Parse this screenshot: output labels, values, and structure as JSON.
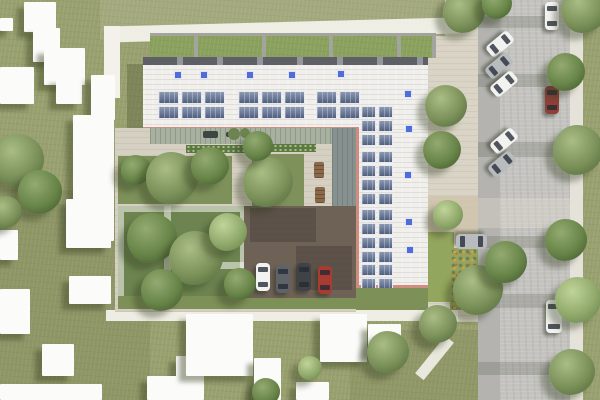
{
  "meta": {
    "description": "Aerial architectural site-plan rendering: L-shaped building with white roof, rooftop solar panel arrays and blue skylights, green roof strips, inner courtyard garden with pergola and tree plots, small parking court with four cars, surrounding lawn with abstract white neighbor buildings, and a street on the right with angle-parked and moving cars, sidewalk and trees"
  },
  "palette": {
    "lawn": "#99a06f",
    "plaza": "#dad4c6",
    "gravel": "#cfc3ab",
    "street": "#c4c3c0",
    "street_lane": "#b4b3b0",
    "sidewalk": "#e5e2da",
    "path_white": "#f3f1ea",
    "roof": "#f0efec",
    "roof_edge": "#62646a",
    "parapet": "#cf8d80",
    "green_roof": "#8aa15e",
    "divider": "#a3a49e",
    "skylight": "#4f6cd8",
    "solar": "#5a6b8c",
    "deck": "#a8b0a0",
    "canopy": "#87918f",
    "garden": "#7e915b",
    "garden_dense": "#6d8450",
    "hedge": "#5d7847",
    "green_strip": "#7d9057",
    "parking": "#6e6156",
    "flower_base": "#95a45e",
    "bench": "#8a6a4a",
    "car_white": "#f2f2f0",
    "car_silver": "#b9bcbe",
    "car_gray": "#5f6368",
    "car_black": "#3f4347",
    "car_red": "#a83c32",
    "car_maroon": "#8d4038"
  },
  "layers": {
    "ground": [
      {
        "x": 0,
        "y": 0,
        "w": 600,
        "h": 400,
        "fill": "lawn",
        "cls": "tex-lawn"
      },
      {
        "x": 0,
        "y": 190,
        "w": 150,
        "h": 210,
        "fill": "rgba(84,94,52,0.15)"
      },
      {
        "x": 350,
        "y": 330,
        "w": 130,
        "h": 70,
        "fill": "rgba(84,94,52,0.12)"
      },
      {
        "x": 100,
        "y": 0,
        "w": 380,
        "h": 40,
        "fill": "rgba(255,255,252,0.10)"
      }
    ],
    "east_plaza": [
      {
        "x": 428,
        "y": 36,
        "w": 50,
        "h": 286,
        "fill": "plaza",
        "cls": "tex-pave"
      },
      {
        "x": 445,
        "y": 0,
        "w": 33,
        "h": 36,
        "fill": "plaza",
        "cls": "tex-pave"
      },
      {
        "x": 428,
        "y": 196,
        "w": 50,
        "h": 40,
        "fill": "gravel",
        "op": 0.85
      },
      {
        "x": 428,
        "y": 232,
        "w": 26,
        "h": 70,
        "fill": "#93a65d"
      },
      {
        "x": 450,
        "y": 248,
        "w": 28,
        "h": 62,
        "fill": "flower_base",
        "cls": "flowers"
      }
    ],
    "street": {
      "road": {
        "x": 478,
        "y": 0,
        "w": 92,
        "h": 400,
        "fill": "street",
        "cls": "tex-road"
      },
      "parking_lane": {
        "x": 478,
        "y": 0,
        "w": 22,
        "h": 400,
        "fill": "street_lane"
      },
      "sidewalk": {
        "x": 570,
        "y": 0,
        "w": 13,
        "h": 400,
        "fill": "sidewalk"
      },
      "crossing": {
        "x": 478,
        "y": 198,
        "w": 92,
        "h": 30,
        "fill": "rgba(236,231,216,0.28)"
      },
      "tree_shadows": [
        {
          "x": 478,
          "y": 16,
          "w": 66,
          "h": 12,
          "fill": "rgba(82,88,74,0.22)"
        },
        {
          "x": 478,
          "y": 74,
          "w": 82,
          "h": 13,
          "fill": "rgba(82,88,74,0.22)"
        },
        {
          "x": 478,
          "y": 142,
          "w": 88,
          "h": 15,
          "fill": "rgba(82,88,74,0.22)"
        },
        {
          "x": 478,
          "y": 236,
          "w": 74,
          "h": 12,
          "fill": "rgba(82,88,74,0.22)"
        },
        {
          "x": 478,
          "y": 294,
          "w": 86,
          "h": 14,
          "fill": "rgba(82,88,74,0.22)"
        },
        {
          "x": 478,
          "y": 362,
          "w": 72,
          "h": 13,
          "fill": "rgba(82,88,74,0.22)"
        }
      ]
    },
    "paths": [
      {
        "x": 104,
        "y": 22,
        "w": 356,
        "h": 16,
        "rot": -1.5,
        "fill": "path_white",
        "op": 0.95
      },
      {
        "x": 104,
        "y": 26,
        "w": 16,
        "h": 72,
        "fill": "path_white"
      },
      {
        "x": 106,
        "y": 310,
        "w": 352,
        "h": 11,
        "fill": "path_white",
        "op": 0.95
      },
      {
        "x": 429,
        "y": 334,
        "w": 11,
        "h": 48,
        "rot": 39,
        "fill": "path_white",
        "op": 0.9
      }
    ],
    "neighbor_buildings": [
      {
        "x": 24,
        "y": 2,
        "w": 32,
        "h": 30
      },
      {
        "x": 33,
        "y": 28,
        "w": 27,
        "h": 34
      },
      {
        "x": 44,
        "y": 48,
        "w": 41,
        "h": 37
      },
      {
        "x": 0,
        "y": 67,
        "w": 34,
        "h": 37
      },
      {
        "x": 56,
        "y": 78,
        "w": 26,
        "h": 26
      },
      {
        "x": 0,
        "y": 18,
        "w": 13,
        "h": 13
      },
      {
        "x": 91,
        "y": 75,
        "w": 24,
        "h": 45
      },
      {
        "x": 73,
        "y": 115,
        "w": 41,
        "h": 126
      },
      {
        "x": 66,
        "y": 199,
        "w": 45,
        "h": 49
      },
      {
        "x": 69,
        "y": 276,
        "w": 42,
        "h": 28
      },
      {
        "x": 0,
        "y": 289,
        "w": 30,
        "h": 45
      },
      {
        "x": 42,
        "y": 344,
        "w": 32,
        "h": 32
      },
      {
        "x": 0,
        "y": 230,
        "w": 18,
        "h": 30
      },
      {
        "x": 176,
        "y": 356,
        "w": 28,
        "h": 44
      },
      {
        "x": 147,
        "y": 376,
        "w": 30,
        "h": 24
      },
      {
        "x": 186,
        "y": 314,
        "w": 67,
        "h": 62
      },
      {
        "x": 254,
        "y": 358,
        "w": 27,
        "h": 42
      },
      {
        "x": 320,
        "y": 314,
        "w": 47,
        "h": 48
      },
      {
        "x": 368,
        "y": 324,
        "w": 33,
        "h": 30
      },
      {
        "x": 296,
        "y": 382,
        "w": 33,
        "h": 18
      },
      {
        "x": 0,
        "y": 384,
        "w": 102,
        "h": 16
      }
    ],
    "building": {
      "green_strip_border": {
        "x": 150,
        "y": 33,
        "w": 286,
        "h": 4,
        "fill": "divider"
      },
      "green_strips": {
        "x": 150,
        "y": 36,
        "w": 286,
        "h": 22,
        "fill": "green_roof",
        "cls": "tex-lawn"
      },
      "strip_dividers": [
        194,
        262,
        329,
        397,
        432
      ],
      "roof_edge": {
        "x": 143,
        "y": 57,
        "w": 285,
        "h": 8
      },
      "shadow_west": {
        "x": 127,
        "y": 64,
        "w": 16,
        "h": 66,
        "fill": "rgba(62,72,40,0.30)"
      },
      "top_wing": {
        "x": 143,
        "y": 65,
        "w": 285,
        "h": 65,
        "fill": "roof",
        "cls": "tex-roof"
      },
      "right_wing": {
        "x": 356,
        "y": 130,
        "w": 72,
        "h": 158,
        "fill": "roof",
        "cls": "tex-roof"
      },
      "parapets": [
        {
          "x": 143,
          "y": 127,
          "w": 213,
          "h": 3
        },
        {
          "x": 356,
          "y": 127,
          "w": 3,
          "h": 161
        },
        {
          "x": 356,
          "y": 285,
          "w": 72,
          "h": 3
        }
      ],
      "skylights": [
        [
          174,
          71
        ],
        [
          200,
          71
        ],
        [
          246,
          71
        ],
        [
          288,
          71
        ],
        [
          337,
          70
        ],
        [
          404,
          90
        ],
        [
          405,
          125
        ],
        [
          404,
          171
        ],
        [
          405,
          218
        ],
        [
          406,
          246
        ]
      ],
      "solar_top": [
        {
          "x": 158,
          "y": 91,
          "cols": 3,
          "rows": 2
        },
        {
          "x": 238,
          "y": 91,
          "cols": 3,
          "rows": 2
        },
        {
          "x": 316,
          "y": 91,
          "cols": 2,
          "rows": 2
        }
      ],
      "solar_right": [
        {
          "x": 361,
          "y": 106,
          "cols": 2,
          "rows": 3
        },
        {
          "x": 361,
          "y": 151,
          "cols": 2,
          "rows": 4
        },
        {
          "x": 361,
          "y": 209,
          "cols": 2,
          "rows": 4
        },
        {
          "x": 361,
          "y": 264,
          "cols": 2,
          "rows": 2
        }
      ]
    },
    "courtyard": {
      "ground": {
        "x": 115,
        "y": 128,
        "w": 241,
        "h": 184,
        "fill": "#d6d0c2",
        "cls": "tex-pave"
      },
      "deck": {
        "x": 150,
        "y": 128,
        "w": 206,
        "h": 16,
        "fill": "deck"
      },
      "deck_items": [
        {
          "x": 203,
          "y": 131,
          "w": 15,
          "h": 7
        },
        {
          "x": 226,
          "y": 132,
          "w": 9,
          "h": 5
        }
      ],
      "deck_plants": [
        [
          234,
          134,
          6
        ],
        [
          245,
          133,
          5
        ]
      ],
      "canopy": {
        "x": 332,
        "y": 128,
        "w": 24,
        "h": 126,
        "fill": "canopy"
      },
      "hedges": [
        {
          "x": 186,
          "y": 145,
          "w": 66,
          "h": 8,
          "fill": "hedge"
        },
        {
          "x": 258,
          "y": 144,
          "w": 58,
          "h": 8,
          "fill": "hedge"
        }
      ],
      "plots": [
        {
          "x": 118,
          "y": 156,
          "w": 114,
          "h": 48,
          "fill": "garden"
        },
        {
          "x": 252,
          "y": 154,
          "w": 52,
          "h": 80,
          "fill": "garden"
        },
        {
          "x": 118,
          "y": 206,
          "w": 128,
          "h": 102,
          "fill": "garden_dense"
        }
      ],
      "pergola": {
        "x": 118,
        "y": 206,
        "w": 128,
        "h": 102
      },
      "pergola_bars": [
        {
          "x": 164,
          "y": 206,
          "w": 7,
          "h": 102
        },
        {
          "x": 171,
          "y": 262,
          "w": 75,
          "h": 7
        }
      ],
      "benches": [
        [
          314,
          162
        ],
        [
          315,
          187
        ],
        [
          315,
          212
        ]
      ],
      "green_strips": [
        {
          "x": 118,
          "y": 296,
          "w": 238,
          "h": 13,
          "fill": "green_strip"
        },
        {
          "x": 356,
          "y": 288,
          "w": 72,
          "h": 22,
          "fill": "green_strip"
        }
      ],
      "parking": {
        "x": 244,
        "y": 206,
        "w": 112,
        "h": 92,
        "fill": "parking",
        "cls": "tex-pave"
      },
      "parking_shadows": [
        {
          "x": 250,
          "y": 208,
          "w": 66,
          "h": 34,
          "fill": "rgba(40,36,30,0.25)"
        },
        {
          "x": 296,
          "y": 246,
          "w": 56,
          "h": 44,
          "fill": "rgba(40,36,30,0.25)"
        }
      ]
    },
    "vehicles": {
      "courtyard_parked": [
        {
          "x": 256,
          "y": 263,
          "color": "car_white"
        },
        {
          "x": 276,
          "y": 265,
          "color": "car_gray"
        },
        {
          "x": 297,
          "y": 263,
          "color": "car_black"
        },
        {
          "x": 318,
          "y": 266,
          "color": "car_red"
        }
      ],
      "plaza_parked": [
        {
          "x": 464,
          "y": 226,
          "w": 15,
          "h": 31,
          "rot": 90,
          "color": "car_silver"
        }
      ],
      "street_parked": [
        {
          "x": 545,
          "y": 2,
          "color": "car_white"
        }
      ],
      "street_angled": [
        {
          "x": 493,
          "y": 30,
          "rot": 50,
          "color": "car_white"
        },
        {
          "x": 492,
          "y": 52,
          "rot": 50,
          "color": "car_silver"
        },
        {
          "x": 497,
          "y": 70,
          "rot": 50,
          "color": "car_white"
        },
        {
          "x": 497,
          "y": 127,
          "rot": 50,
          "color": "car_white"
        },
        {
          "x": 495,
          "y": 150,
          "rot": 50,
          "color": "car_silver"
        }
      ],
      "street_moving": [
        {
          "x": 545,
          "y": 86,
          "color": "car_maroon"
        },
        {
          "x": 546,
          "y": 300,
          "w": 16,
          "h": 33,
          "color": "car_white"
        }
      ]
    },
    "trees": [
      [
        18,
        160,
        26,
        1
      ],
      [
        40,
        192,
        22,
        2
      ],
      [
        6,
        212,
        16,
        1
      ],
      [
        136,
        170,
        15,
        2
      ],
      [
        172,
        178,
        26,
        1
      ],
      [
        210,
        166,
        19,
        2
      ],
      [
        268,
        182,
        25,
        1
      ],
      [
        258,
        146,
        15,
        2
      ],
      [
        152,
        238,
        25,
        2
      ],
      [
        196,
        258,
        27,
        1
      ],
      [
        162,
        290,
        21,
        2
      ],
      [
        228,
        232,
        19,
        0
      ],
      [
        240,
        284,
        16,
        2
      ],
      [
        446,
        106,
        21,
        1
      ],
      [
        442,
        150,
        19,
        2
      ],
      [
        448,
        215,
        15,
        0
      ],
      [
        478,
        290,
        25,
        1
      ],
      [
        506,
        262,
        21,
        2
      ],
      [
        438,
        324,
        19,
        1
      ],
      [
        464,
        12,
        21,
        1
      ],
      [
        497,
        4,
        15,
        2
      ],
      [
        584,
        10,
        23,
        1
      ],
      [
        566,
        72,
        19,
        2
      ],
      [
        578,
        150,
        25,
        1
      ],
      [
        566,
        240,
        21,
        2
      ],
      [
        578,
        300,
        23,
        0
      ],
      [
        572,
        372,
        23,
        1
      ],
      [
        388,
        352,
        21,
        1
      ],
      [
        266,
        392,
        14,
        2
      ],
      [
        310,
        368,
        12,
        0
      ]
    ]
  }
}
